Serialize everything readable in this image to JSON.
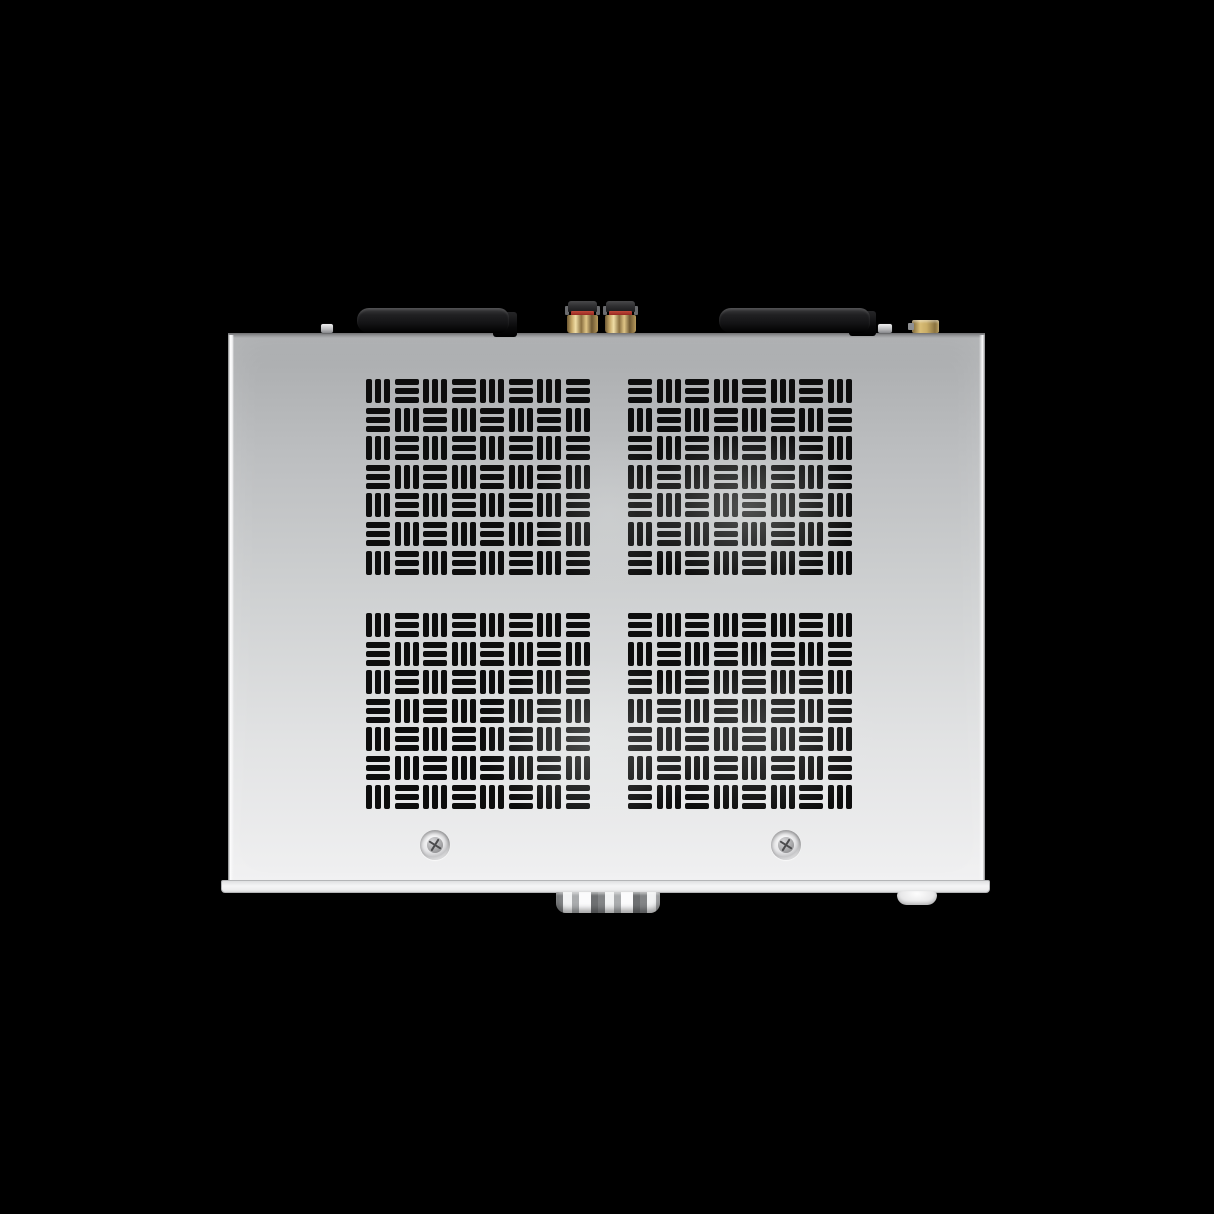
{
  "scene": {
    "description": "Top view product photo of a silver hi-fi amplifier chassis on a black background",
    "colors": {
      "background": "#000000",
      "body_top": "#a9abad",
      "body_mid": "#cfd1d2",
      "body_bottom": "#f0f0f1",
      "vent": "#0d0d0d",
      "antenna": "#141416",
      "rca_cap": "#2b2b2d",
      "rca_red": "#9c2b24",
      "rca_gold": "#c0a263",
      "sma_gold": "#c8ac66",
      "lip": "#f5f5f6",
      "knob_light": "#f1f2f3",
      "knob_dark": "#6e7072"
    }
  },
  "device": {
    "grilles": {
      "cols": 8,
      "rows": 7,
      "bars_per_cell": 3,
      "quadrants": [
        {
          "id": "top-left",
          "first_cell": "vertical"
        },
        {
          "id": "top-right",
          "first_cell": "horizontal"
        },
        {
          "id": "bottom-left",
          "first_cell": "vertical"
        },
        {
          "id": "bottom-right",
          "first_cell": "horizontal"
        }
      ]
    },
    "hardware": {
      "antennas": 2,
      "rca_jacks": 2,
      "sma_connectors": 1,
      "edge_screws": 2,
      "surface_screws": 2,
      "knobs": 1,
      "feet_visible": 1
    }
  }
}
